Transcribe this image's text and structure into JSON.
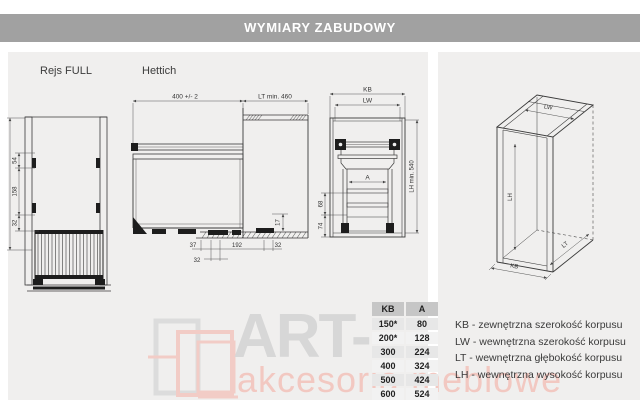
{
  "header": {
    "title": "WYMIARY ZABUDOWY"
  },
  "section_labels": {
    "rejs": "Rejs FULL",
    "hettich": "Hettich"
  },
  "dimensions": {
    "basket_front": {
      "d1": "54",
      "d2": "158",
      "d3": "32"
    },
    "side_view": {
      "width_top": "400 +/- 2",
      "depth_top": "LT min. 460",
      "bottom_1": "37",
      "bottom_2": "192",
      "bottom_3": "32",
      "bottom_4": "32",
      "side_1": "17"
    },
    "cabinet_front": {
      "kb": "KB",
      "lw": "LW",
      "lh": "LH min. 540",
      "a": "A",
      "left_1": "68",
      "left_2": "74"
    },
    "cabinet_iso": {
      "kb": "KB",
      "lw": "LW",
      "lh": "LH",
      "lt": "LT"
    }
  },
  "table": {
    "headers": [
      "KB",
      "A"
    ],
    "rows": [
      [
        "150*",
        "80"
      ],
      [
        "200*",
        "128"
      ],
      [
        "300",
        "224"
      ],
      [
        "400",
        "324"
      ],
      [
        "500",
        "424"
      ],
      [
        "600",
        "524"
      ]
    ]
  },
  "legend": {
    "items": [
      "KB - zewnętrzna szerokość korpusu",
      "LW - wewnętrzna szerokość korpusu",
      "LT - wewnętrzna głębokość korpusu",
      "LH - wewnętrzna wysokość korpusu"
    ]
  },
  "watermark": {
    "brand": "ART-",
    "tagline": "akcesoria meblowe"
  },
  "colors": {
    "header_bg": "#a1a1a1",
    "panel_bg": "#f0efee",
    "table_header_bg": "#c6c6c6",
    "line": "#3a3a3a",
    "watermark_gray": "#d7d7d7",
    "watermark_red": "#f2c8c1"
  }
}
